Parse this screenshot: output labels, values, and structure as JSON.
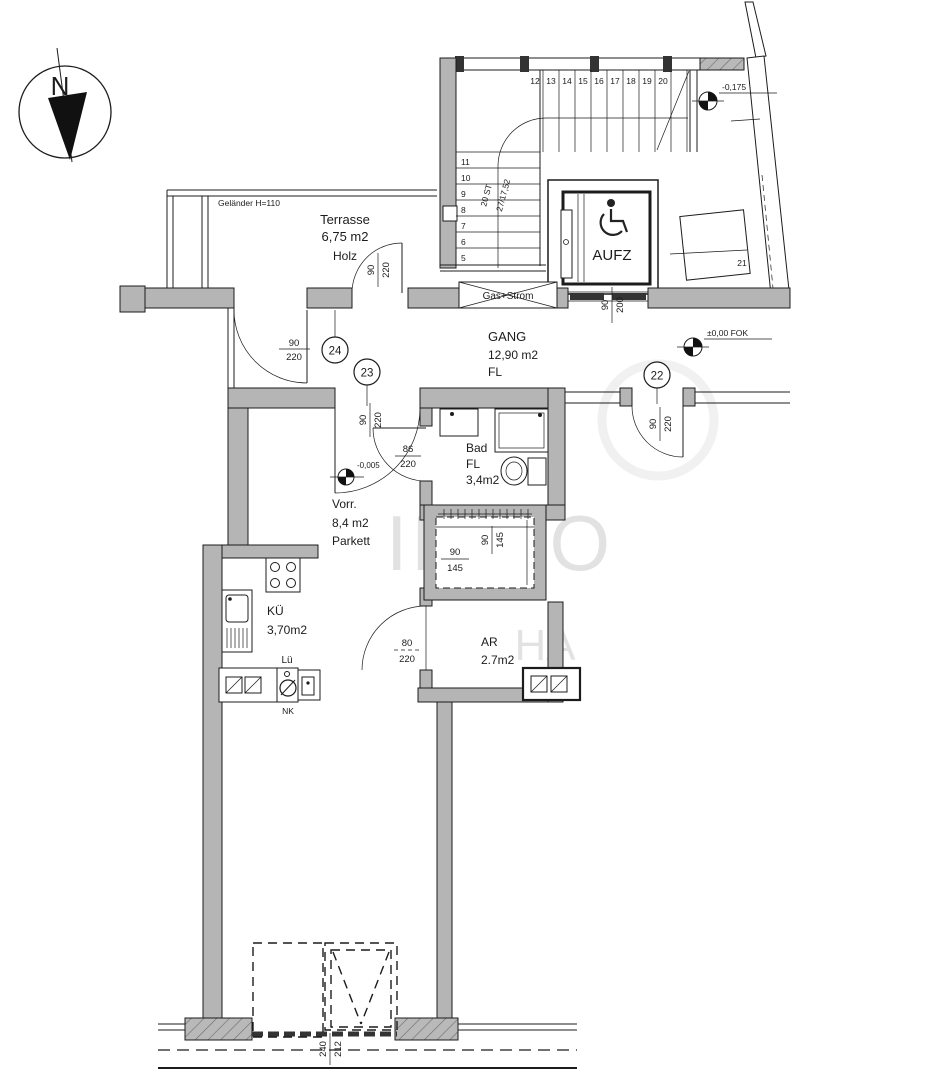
{
  "compass": {
    "north": "N"
  },
  "levels": {
    "upper": "-0,175",
    "gang": "±0,00 FOK",
    "vorraum": "-0,005"
  },
  "stairs": {
    "upper": [
      "12",
      "13",
      "14",
      "15",
      "16",
      "17",
      "18",
      "19",
      "20"
    ],
    "lower": [
      "11",
      "10",
      "9",
      "8",
      "7",
      "6",
      "5"
    ],
    "count_note": "20 ST",
    "step_note": "27/17,52"
  },
  "elevator": {
    "label": "AUFZ"
  },
  "utility": {
    "gas": "Gas+Strom"
  },
  "terrace": {
    "name": "Terrasse",
    "area": "6,75 m2",
    "floor": "Holz",
    "railing": "Geländer H=110"
  },
  "gang": {
    "name": "GANG",
    "area": "12,90 m2",
    "floor": "FL"
  },
  "vorraum": {
    "name": "Vorr.",
    "area": "8,4 m2",
    "floor": "Parkett"
  },
  "bad": {
    "name": "Bad",
    "floor": "FL",
    "area": "3,4m2"
  },
  "kueche": {
    "name": "KÜ",
    "area": "3,70m2",
    "vent": "Lü",
    "nk": "NK"
  },
  "ar": {
    "name": "AR",
    "area": "2.7m2"
  },
  "doors": {
    "d22": "22",
    "d23": "23",
    "d24": "24",
    "unit21": "21"
  },
  "door_dims": {
    "d22": {
      "w": "90",
      "h": "220"
    },
    "d23": {
      "w": "90",
      "h": "220"
    },
    "d24": {
      "w": "90",
      "h": "220"
    },
    "terrace": {
      "w": "90",
      "h": "220"
    },
    "elevator": {
      "w": "90",
      "h": "200"
    },
    "bad": {
      "w": "86",
      "h": "220"
    },
    "ar": {
      "w": "80",
      "h": "220"
    }
  },
  "windows": {
    "shaft": {
      "w": "90",
      "h": "145"
    },
    "bottom": {
      "w": "240",
      "h": "212"
    }
  },
  "watermark": {
    "a": "IMMO",
    "b": "HA"
  }
}
